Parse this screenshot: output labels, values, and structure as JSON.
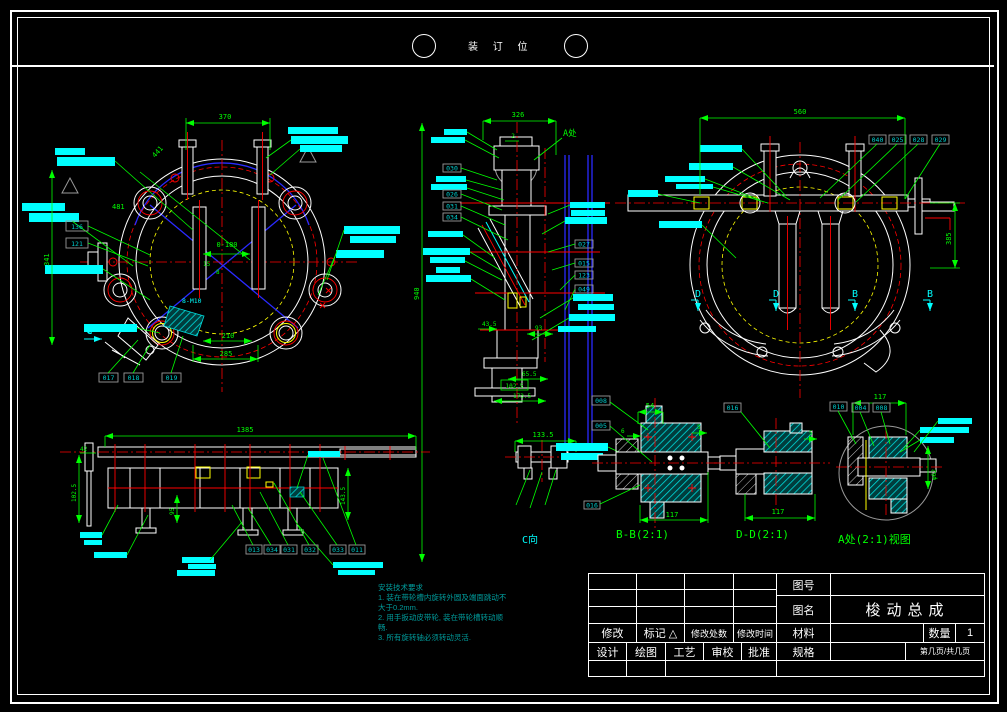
{
  "page": {
    "binding_text": "装 订 位"
  },
  "colors": {
    "background": "#000000",
    "line": "#ffffff",
    "dimension": "#00ff00",
    "highlight": "#00ffff",
    "note_text": "#009b9b",
    "centerline": "#ff0000",
    "auxiliary": "#2a2aff",
    "hatch_accent": "#ffff00"
  },
  "views": {
    "front": {
      "dims": [
        "370",
        "441",
        "481",
        "341",
        "0-180",
        "15",
        "8",
        "210",
        "285"
      ],
      "thread_note": "8-M10",
      "balloons": [
        "136",
        "121",
        "017",
        "018",
        "019"
      ],
      "direction_label": "C"
    },
    "side": {
      "dims": [
        "326",
        "2",
        "940",
        "43.5",
        "93",
        "65.5",
        "102.5",
        "173.5"
      ],
      "detail_label": "A处",
      "balloons_left": [
        "030",
        "026",
        "031",
        "034"
      ],
      "balloons_right": [
        "027",
        "015",
        "123",
        "049"
      ]
    },
    "rear": {
      "dims": [
        "560",
        "385"
      ],
      "balloons": [
        "040",
        "025",
        "028",
        "029"
      ],
      "section_labels": [
        "D",
        "D",
        "B",
        "B"
      ]
    },
    "bottom": {
      "dims": [
        "1385",
        "42",
        "102.5",
        "95",
        "143.5"
      ],
      "balloons": [
        "013",
        "034",
        "031",
        "032",
        "033",
        "011"
      ]
    },
    "c_view": {
      "label": "C向",
      "dims": [
        "133.5"
      ]
    },
    "bb_view": {
      "label": "B-B(2:1)",
      "dims": [
        "54",
        "6",
        "5",
        "117"
      ],
      "balloons": [
        "008",
        "005",
        "016"
      ]
    },
    "dd_view": {
      "label": "D-D(2:1)",
      "dims": [
        "5",
        "117"
      ],
      "balloons": [
        "016"
      ]
    },
    "a_view": {
      "label": "A处(2:1)视图",
      "dims": [
        "117",
        "φ62"
      ],
      "balloons": [
        "010",
        "004",
        "008"
      ]
    }
  },
  "notes": {
    "title": "安装技术要求",
    "lines": [
      "1. 装在带轮槽内旋转外圆及端面跳动不",
      "大于0.2mm.",
      "2. 用手扳动皮带轮, 装在带轮槽转动顺",
      "畅.",
      "3. 所有旋转轴必须转动灵活."
    ]
  },
  "title_block": {
    "drawing_no_label": "图号",
    "drawing_name_label": "图名",
    "drawing_name": "梭动总成",
    "material_label": "材料",
    "quantity_label": "数量",
    "quantity": "1",
    "spec_label": "规格",
    "page_label": "第几页/共几页",
    "revision_label": "修改",
    "mark_label": "标记",
    "mark_symbol": "△",
    "rev_count_label": "修改处数",
    "rev_date_label": "修改时间",
    "design_label": "设计",
    "draft_label": "绘图",
    "process_label": "工艺",
    "check_label": "审校",
    "approve_label": "批准"
  }
}
